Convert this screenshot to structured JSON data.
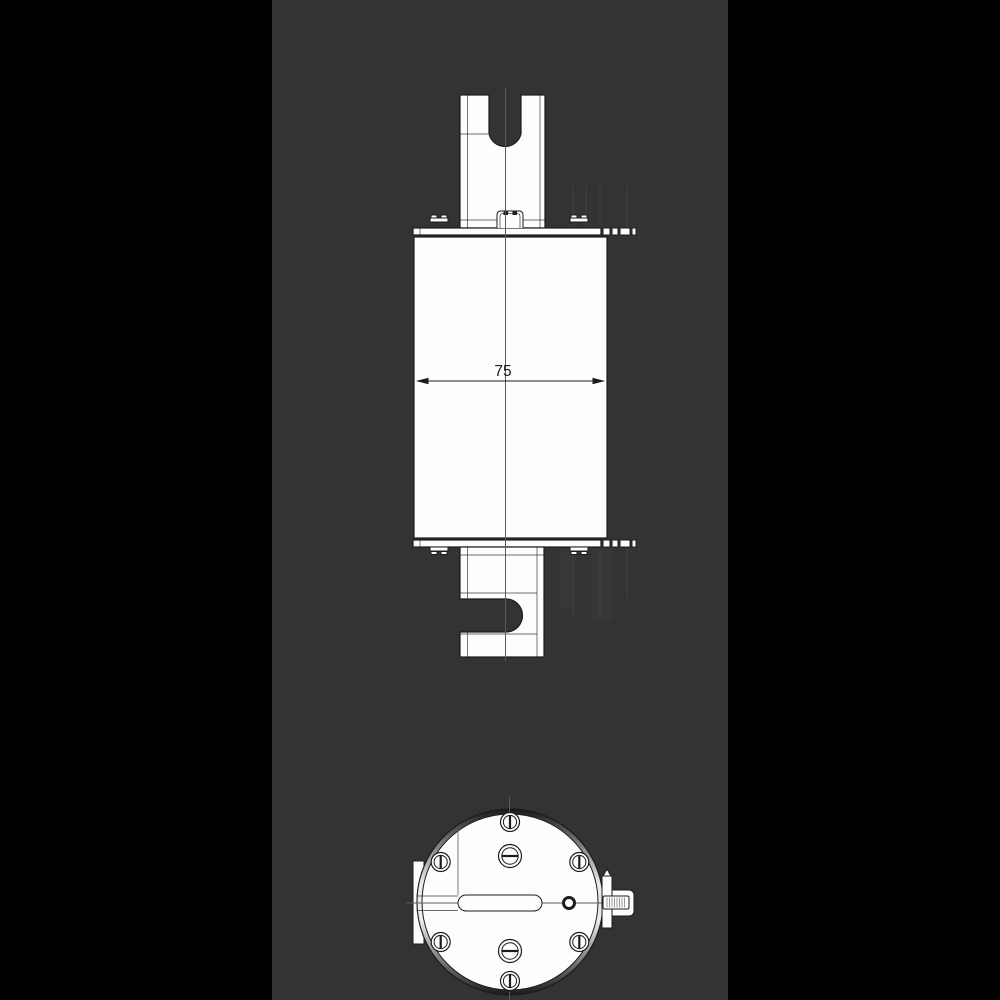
{
  "colors": {
    "margin": "#000000",
    "panel": "#333333",
    "line": "#1c1c1c",
    "part": "#fdfdfd",
    "centerline": "#5a5a5a",
    "faint": "#3e3e3e",
    "ghost": "#373737",
    "ring_dark": "#191919",
    "ring_light": "#ececec"
  },
  "dimension": {
    "label": "75"
  }
}
